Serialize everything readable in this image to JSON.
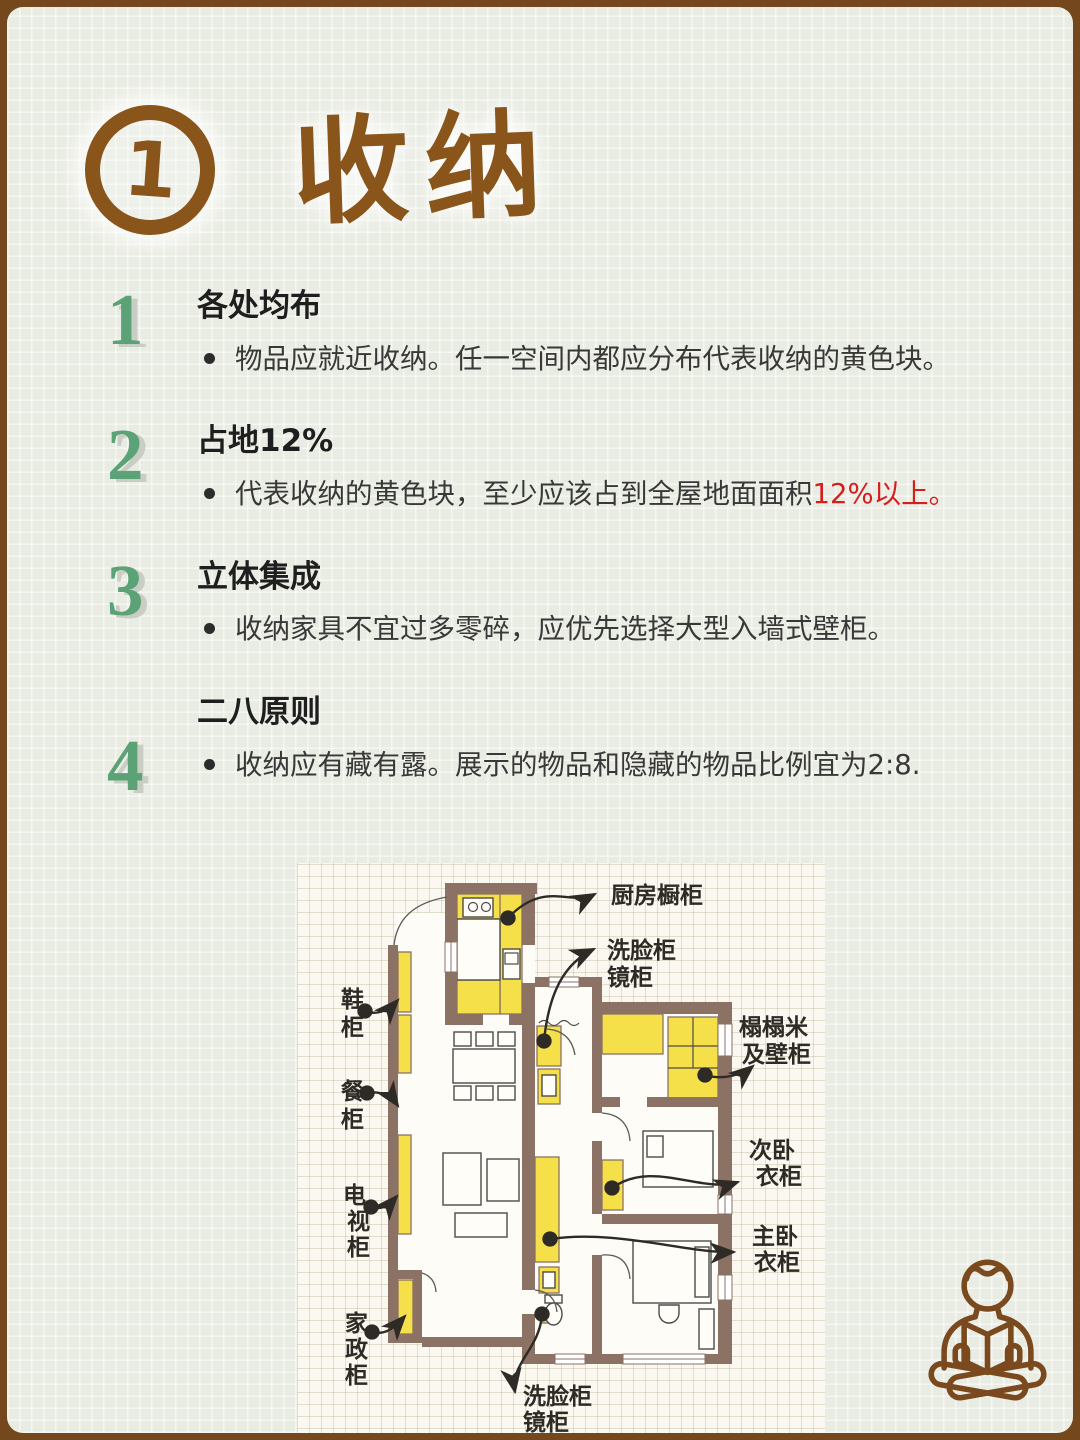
{
  "header": {
    "badge_number": "1",
    "title": "收纳"
  },
  "points": [
    {
      "number": "1",
      "heading": "各处均布",
      "bullet": "物品应就近收纳。任一空间内都应分布代表收纳的黄色块。",
      "bullet_highlight": ""
    },
    {
      "number": "2",
      "heading": "占地12%",
      "bullet": "代表收纳的黄色块，至少应该占到全屋地面面积",
      "bullet_highlight": "12%以上。"
    },
    {
      "number": "3",
      "heading": "立体集成",
      "bullet": "收纳家具不宜过多零碎，应优先选择大型入墙式壁柜。",
      "bullet_highlight": ""
    },
    {
      "number": "4",
      "heading": "二八原则",
      "bullet": "收纳应有藏有露。展示的物品和隐藏的物品比例宜为2:8.",
      "bullet_highlight": ""
    }
  ],
  "floor_plan": {
    "labels": {
      "kitchen": {
        "line1": "厨房橱柜"
      },
      "washbasin_top": {
        "line1": "洗脸柜",
        "line2": "镜柜"
      },
      "shoe": {
        "line1": "鞋",
        "line2": "柜"
      },
      "dining": {
        "line1": "餐",
        "line2": "柜"
      },
      "tatami": {
        "line1": "榻榻米",
        "line2": "及壁柜"
      },
      "second_bedroom": {
        "line1": "次卧",
        "line2": "衣柜"
      },
      "tv": {
        "line1": "电",
        "line2": "视",
        "line3": "柜"
      },
      "master_bedroom": {
        "line1": "主卧",
        "line2": "衣柜"
      },
      "housekeeping": {
        "line1": "家",
        "line2": "政",
        "line3": "柜"
      },
      "washbasin_bottom": {
        "line1": "洗脸柜",
        "line2": "镜柜"
      }
    },
    "colors": {
      "storage_yellow": "#f6e049",
      "wall_brown": "#8b7264"
    }
  },
  "colors": {
    "frame_brown": "#74471c",
    "title_brown": "#8a551b",
    "number_green": "#5ba276",
    "highlight_red": "#d41f1f",
    "page_background": "#e9ece2"
  },
  "footer": {
    "icon": "person-reading-book-icon"
  }
}
